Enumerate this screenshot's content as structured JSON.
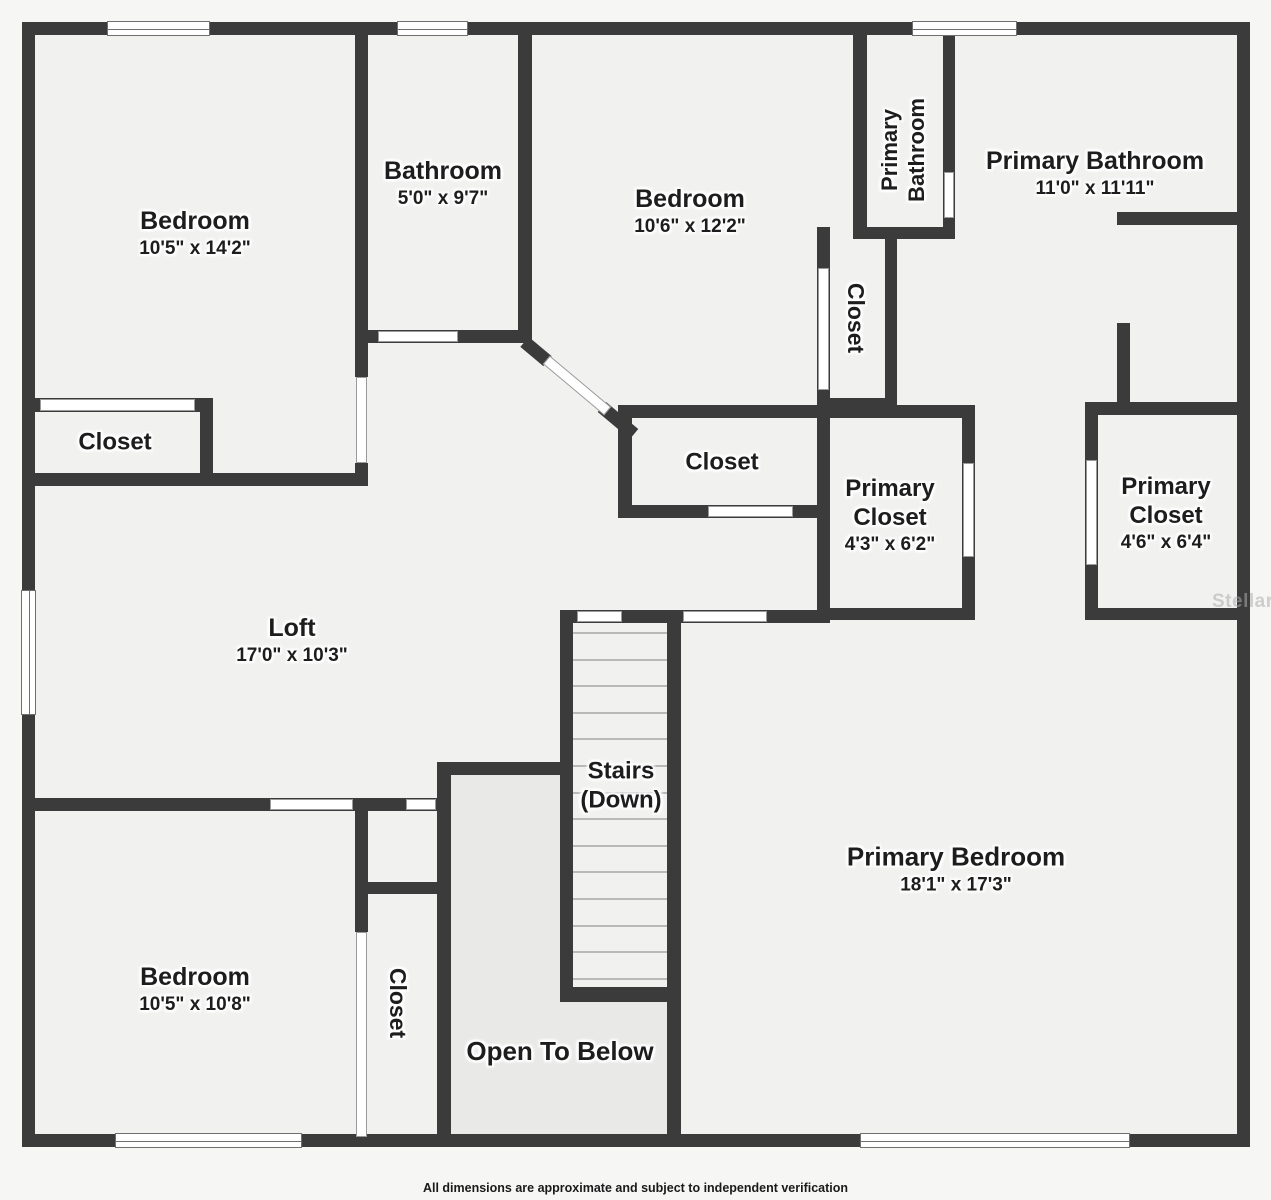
{
  "footer": {
    "text": "All dimensions are approximate and subject to independent verification"
  },
  "watermark": {
    "text": "StellarMLS"
  },
  "floorplan": {
    "canvas": {
      "width": 1271,
      "height": 1200
    },
    "colors": {
      "wall": "#3b3b3b",
      "room_fill": "#f1f1f0",
      "open_below_fill": "#e9e9e8",
      "outside": "#f6f6f5",
      "label_text": "#1d1d1d"
    },
    "plan_bg": [
      22,
      22,
      1228,
      1125
    ],
    "walls": [
      [
        22,
        22,
        1228,
        13
      ],
      [
        22,
        22,
        13,
        1125
      ],
      [
        1237,
        22,
        13,
        1125
      ],
      [
        22,
        1134,
        1228,
        13
      ],
      [
        355,
        35,
        13,
        342
      ],
      [
        355,
        463,
        13,
        23
      ],
      [
        518,
        35,
        14,
        308
      ],
      [
        355,
        330,
        177,
        13
      ],
      [
        618,
        405,
        212,
        13
      ],
      [
        618,
        405,
        14,
        113
      ],
      [
        618,
        505,
        212,
        13
      ],
      [
        817,
        227,
        13,
        393
      ],
      [
        885,
        227,
        12,
        183
      ],
      [
        818,
        398,
        79,
        12
      ],
      [
        853,
        35,
        14,
        192
      ],
      [
        943,
        35,
        12,
        192
      ],
      [
        853,
        227,
        102,
        12
      ],
      [
        817,
        405,
        158,
        13
      ],
      [
        962,
        405,
        13,
        215
      ],
      [
        817,
        608,
        158,
        12
      ],
      [
        1085,
        402,
        165,
        13
      ],
      [
        1085,
        402,
        13,
        218
      ],
      [
        1085,
        608,
        165,
        12
      ],
      [
        1117,
        212,
        133,
        13
      ],
      [
        1117,
        323,
        13,
        92
      ],
      [
        22,
        398,
        191,
        14
      ],
      [
        200,
        398,
        13,
        88
      ],
      [
        22,
        473,
        346,
        13
      ],
      [
        22,
        798,
        429,
        13
      ],
      [
        355,
        882,
        94,
        12
      ],
      [
        355,
        811,
        13,
        121
      ],
      [
        437,
        762,
        14,
        372
      ],
      [
        437,
        762,
        136,
        13
      ],
      [
        560,
        610,
        13,
        392
      ],
      [
        667,
        610,
        14,
        524
      ],
      [
        560,
        610,
        270,
        13
      ],
      [
        560,
        987,
        120,
        15
      ]
    ],
    "diag_walls": [
      {
        "cx": 536,
        "cy": 351,
        "len": 30,
        "th": 13,
        "ang": 40
      },
      {
        "cx": 618,
        "cy": 420,
        "len": 42,
        "th": 13,
        "ang": 40
      }
    ],
    "doors": [
      [
        356,
        377,
        11,
        86
      ],
      [
        378,
        331,
        80,
        11
      ],
      [
        708,
        506,
        85,
        11
      ],
      [
        818,
        268,
        11,
        122
      ],
      [
        944,
        172,
        10,
        46
      ],
      [
        963,
        463,
        11,
        94
      ],
      [
        1086,
        460,
        11,
        105
      ],
      [
        40,
        399,
        155,
        12
      ],
      [
        270,
        799,
        83,
        11
      ],
      [
        406,
        799,
        30,
        11
      ],
      [
        356,
        932,
        11,
        205
      ],
      [
        577,
        611,
        45,
        11
      ],
      [
        683,
        611,
        84,
        11
      ]
    ],
    "diag_doors": [
      {
        "cx": 577,
        "cy": 385,
        "len": 80,
        "th": 11,
        "ang": 40
      }
    ],
    "windows": [
      {
        "x": 107,
        "y": 21,
        "w": 103,
        "h": 15,
        "o": "h"
      },
      {
        "x": 397,
        "y": 21,
        "w": 71,
        "h": 15,
        "o": "h"
      },
      {
        "x": 912,
        "y": 21,
        "w": 105,
        "h": 15,
        "o": "h"
      },
      {
        "x": 21,
        "y": 590,
        "w": 15,
        "h": 125,
        "o": "v"
      },
      {
        "x": 115,
        "y": 1133,
        "w": 187,
        "h": 15,
        "o": "h"
      },
      {
        "x": 860,
        "y": 1133,
        "w": 270,
        "h": 15,
        "o": "h"
      }
    ],
    "open_areas": [
      [
        451,
        775,
        109,
        359
      ],
      [
        560,
        1002,
        107,
        132
      ]
    ],
    "stairs": {
      "x": 573,
      "w": 94,
      "y_start": 632,
      "step": 26.6,
      "count": 14
    },
    "rooms": [
      {
        "id": "bedroom-1",
        "cx": 195,
        "cy": 233,
        "rot": 0,
        "lines": [
          {
            "t": "Bedroom",
            "fs": 25
          },
          {
            "t": "10'5\" x 14'2\"",
            "fs": 19
          }
        ]
      },
      {
        "id": "bathroom",
        "cx": 443,
        "cy": 183,
        "rot": 0,
        "lines": [
          {
            "t": "Bathroom",
            "fs": 25
          },
          {
            "t": "5'0\" x 9'7\"",
            "fs": 19
          }
        ]
      },
      {
        "id": "bedroom-2",
        "cx": 690,
        "cy": 211,
        "rot": 0,
        "lines": [
          {
            "t": "Bedroom",
            "fs": 25
          },
          {
            "t": "10'6\" x 12'2\"",
            "fs": 19
          }
        ]
      },
      {
        "id": "primary-bathroom-wc",
        "cx": 904,
        "cy": 150,
        "rot": -90,
        "lines": [
          {
            "t": "Primary",
            "fs": 22
          },
          {
            "t": "Bathroom",
            "fs": 22
          }
        ]
      },
      {
        "id": "primary-bathroom",
        "cx": 1095,
        "cy": 173,
        "rot": 0,
        "lines": [
          {
            "t": "Primary Bathroom",
            "fs": 25
          },
          {
            "t": "11'0\" x 11'11\"",
            "fs": 19
          }
        ]
      },
      {
        "id": "closet-bedroom2",
        "cx": 856,
        "cy": 318,
        "rot": 90,
        "lines": [
          {
            "t": "Closet",
            "fs": 23
          }
        ]
      },
      {
        "id": "closet-left",
        "cx": 115,
        "cy": 442,
        "rot": 0,
        "lines": [
          {
            "t": "Closet",
            "fs": 24
          }
        ]
      },
      {
        "id": "closet-middle",
        "cx": 722,
        "cy": 462,
        "rot": 0,
        "lines": [
          {
            "t": "Closet",
            "fs": 24
          }
        ]
      },
      {
        "id": "primary-closet-1",
        "cx": 890,
        "cy": 515,
        "rot": 0,
        "lines": [
          {
            "t": "Primary",
            "fs": 24
          },
          {
            "t": "Closet",
            "fs": 24
          },
          {
            "t": "4'3\" x 6'2\"",
            "fs": 19
          }
        ]
      },
      {
        "id": "primary-closet-2",
        "cx": 1166,
        "cy": 513,
        "rot": 0,
        "lines": [
          {
            "t": "Primary",
            "fs": 24
          },
          {
            "t": "Closet",
            "fs": 24
          },
          {
            "t": "4'6\" x 6'4\"",
            "fs": 19
          }
        ]
      },
      {
        "id": "loft",
        "cx": 292,
        "cy": 640,
        "rot": 0,
        "lines": [
          {
            "t": "Loft",
            "fs": 25
          },
          {
            "t": "17'0\" x 10'3\"",
            "fs": 19
          }
        ]
      },
      {
        "id": "stairs",
        "cx": 621,
        "cy": 786,
        "rot": 0,
        "lines": [
          {
            "t": "Stairs",
            "fs": 24
          },
          {
            "t": "(Down)",
            "fs": 24
          }
        ]
      },
      {
        "id": "primary-bedroom",
        "cx": 956,
        "cy": 869,
        "rot": 0,
        "lines": [
          {
            "t": "Primary Bedroom",
            "fs": 26
          },
          {
            "t": "18'1\" x 17'3\"",
            "fs": 19
          }
        ]
      },
      {
        "id": "bedroom-3",
        "cx": 195,
        "cy": 989,
        "rot": 0,
        "lines": [
          {
            "t": "Bedroom",
            "fs": 25
          },
          {
            "t": "10'5\" x 10'8\"",
            "fs": 19
          }
        ]
      },
      {
        "id": "closet-bottom",
        "cx": 398,
        "cy": 1003,
        "rot": 90,
        "lines": [
          {
            "t": "Closet",
            "fs": 23
          }
        ]
      },
      {
        "id": "open-to-below",
        "cx": 560,
        "cy": 1052,
        "rot": 0,
        "lines": [
          {
            "t": "Open To Below",
            "fs": 26
          }
        ]
      }
    ]
  }
}
